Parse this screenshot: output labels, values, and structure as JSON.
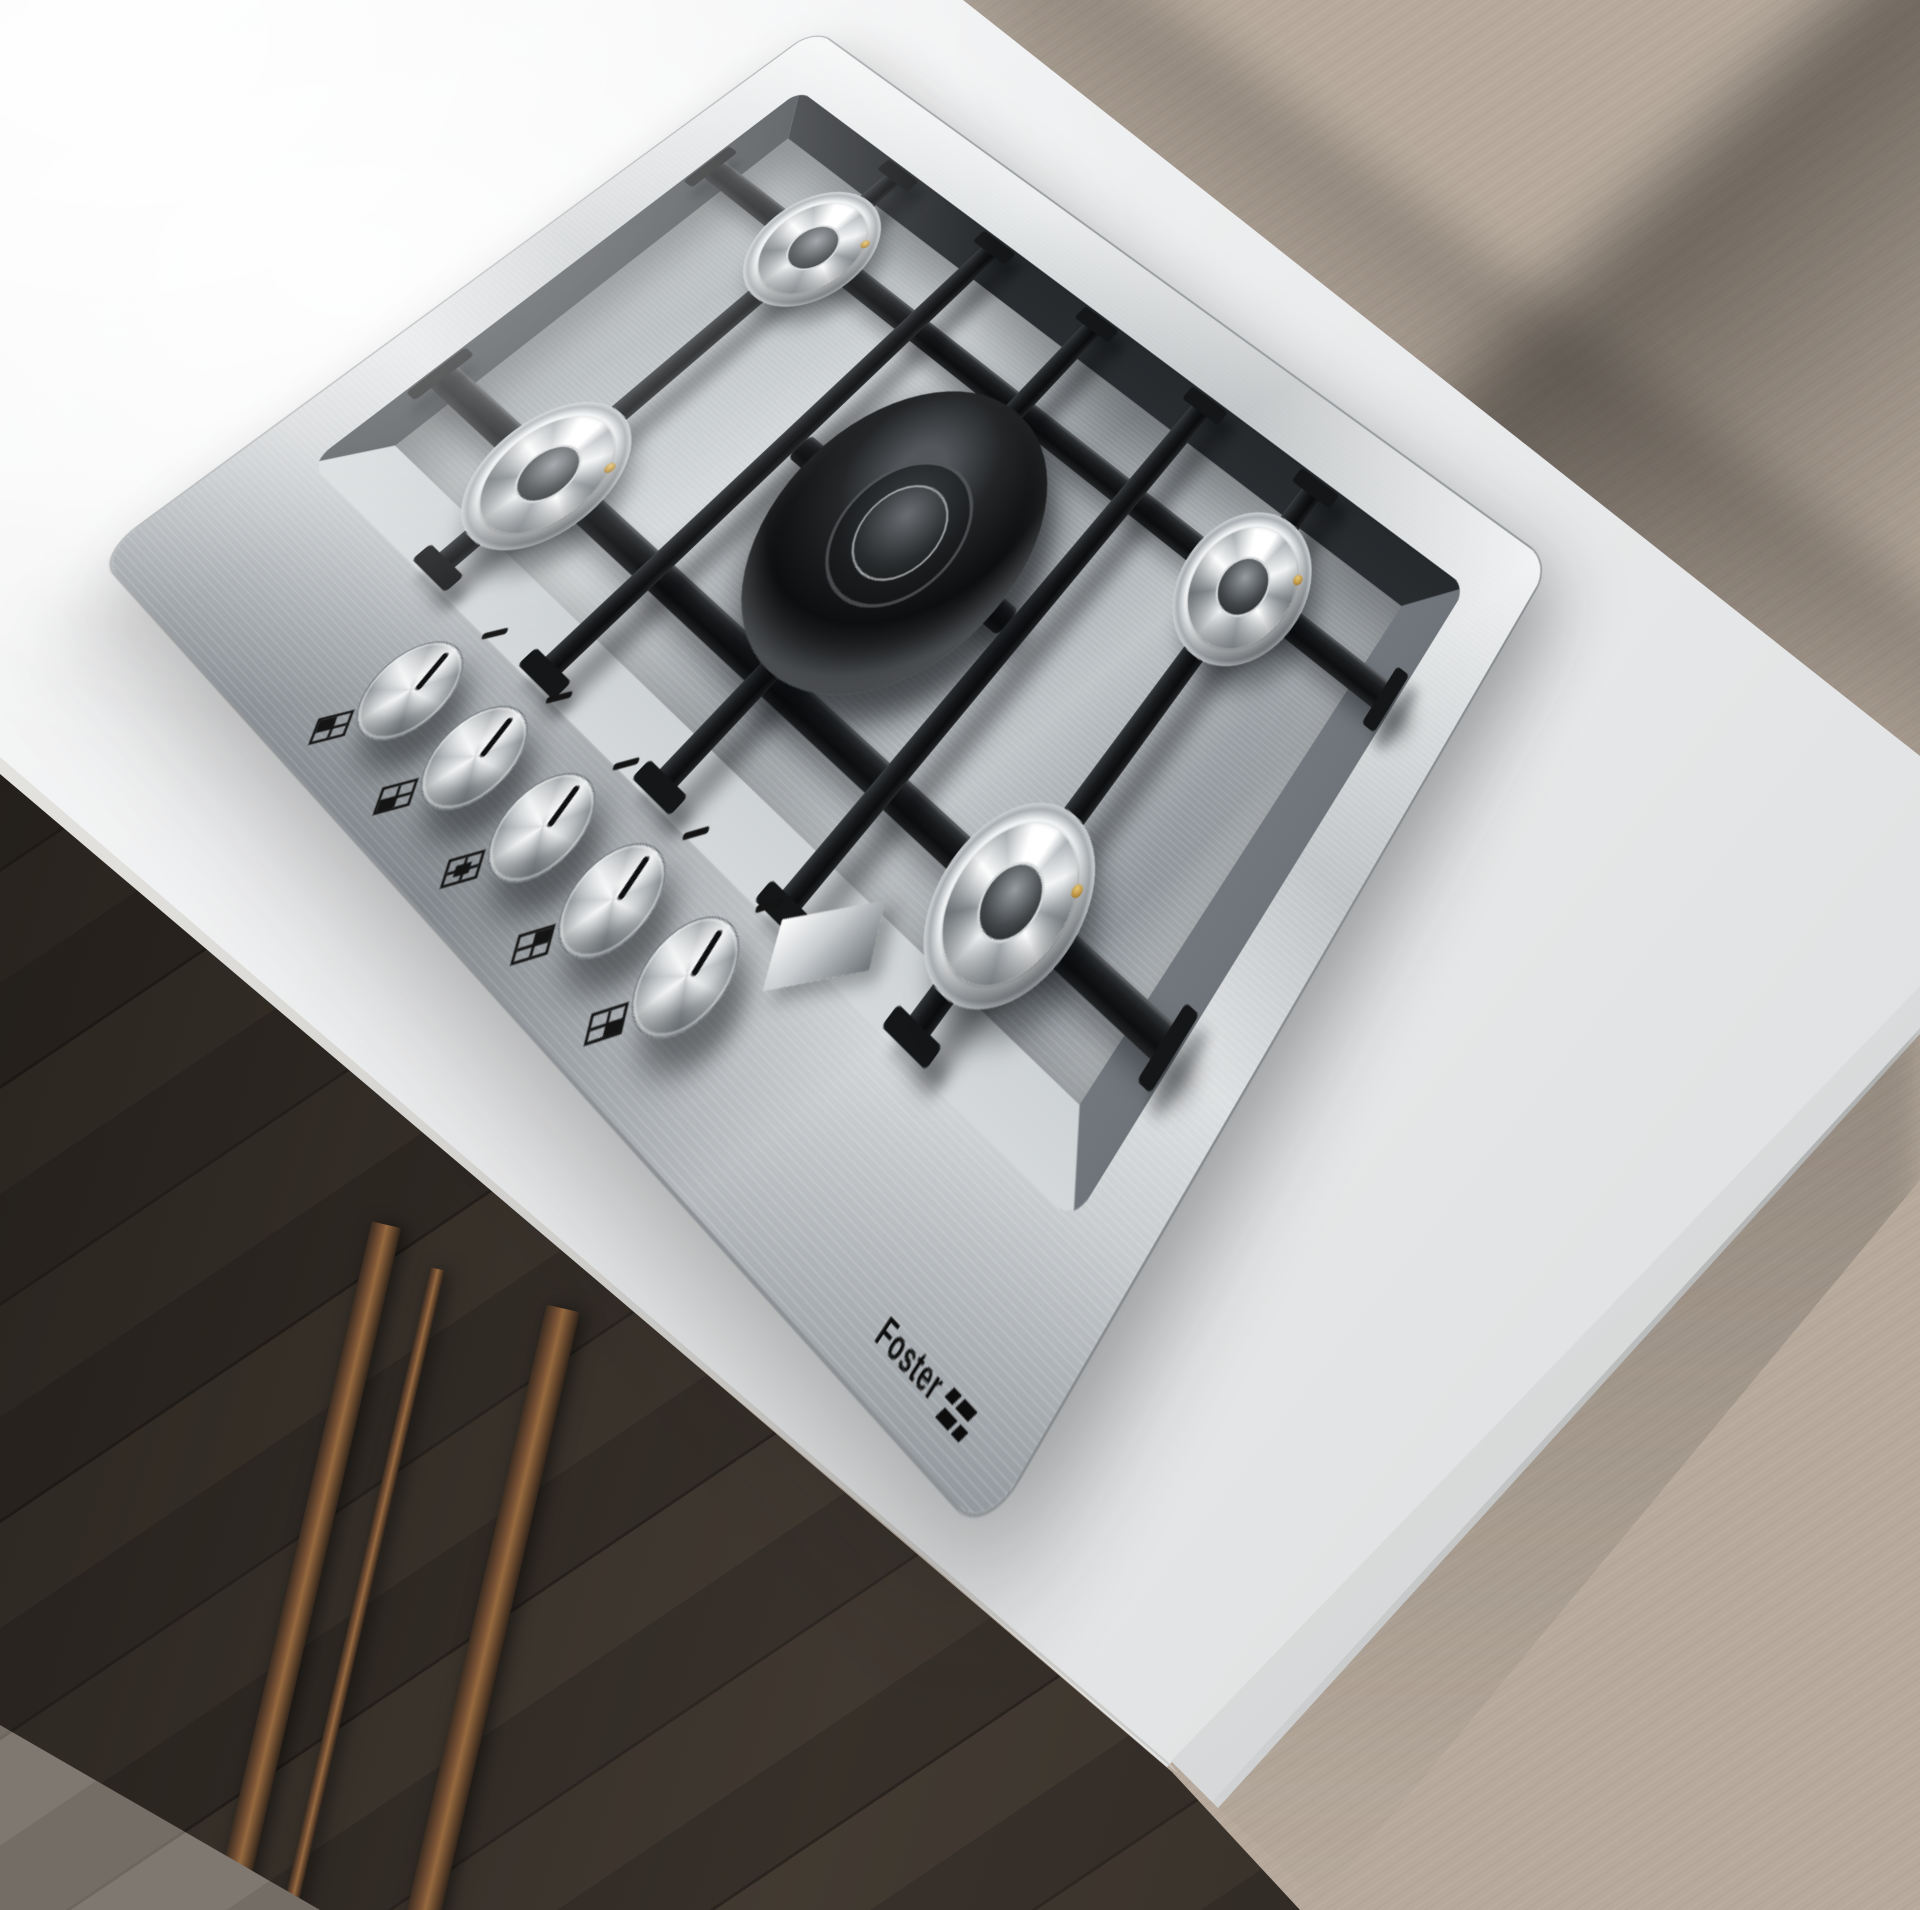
{
  "scene": {
    "type": "product render",
    "subject": "stainless steel 5-burner gas cooktop built into a white kitchen island",
    "environment": "light oak plank wood floor, dark cabinet side with bronze legs in shadow"
  },
  "brand": {
    "name": "Foster",
    "logo_icon": "foster-flag-icon"
  },
  "cooktop": {
    "material": "brushed stainless steel",
    "grates": "black cast iron lattice",
    "burners": [
      {
        "name": "rear-left burner",
        "type": "standard chrome cone"
      },
      {
        "name": "front-left burner",
        "type": "standard chrome cone"
      },
      {
        "name": "center burner",
        "type": "large triple-ring wok"
      },
      {
        "name": "rear-right burner",
        "type": "standard chrome cone"
      },
      {
        "name": "front-right burner",
        "type": "standard chrome cone"
      }
    ],
    "knobs": [
      {
        "label": "rear-left burner knob",
        "state": "off"
      },
      {
        "label": "front-left burner knob",
        "state": "off"
      },
      {
        "label": "center wok burner knob",
        "state": "off"
      },
      {
        "label": "rear-right burner knob",
        "state": "off"
      },
      {
        "label": "front-right burner knob",
        "state": "off"
      }
    ],
    "markings": "off-position dash and burner-position diagram printed beside each knob"
  },
  "counter": {
    "material": "white stone worktop"
  },
  "floor": {
    "material": "whitewashed oak planks laid diagonally"
  },
  "colors": {
    "steel-light": "#e8eaeb",
    "steel-mid": "#b7bcbf",
    "steel-dark": "#7c8286",
    "tub-dark": "#34383c",
    "grate": "#1b1d1f",
    "counter": "#eff0f1",
    "floor": "#b7aa9d",
    "floor-dark": "#4a423a",
    "bronze": "#7d5737",
    "ink": "#141414",
    "gold": "#b98f3e"
  }
}
